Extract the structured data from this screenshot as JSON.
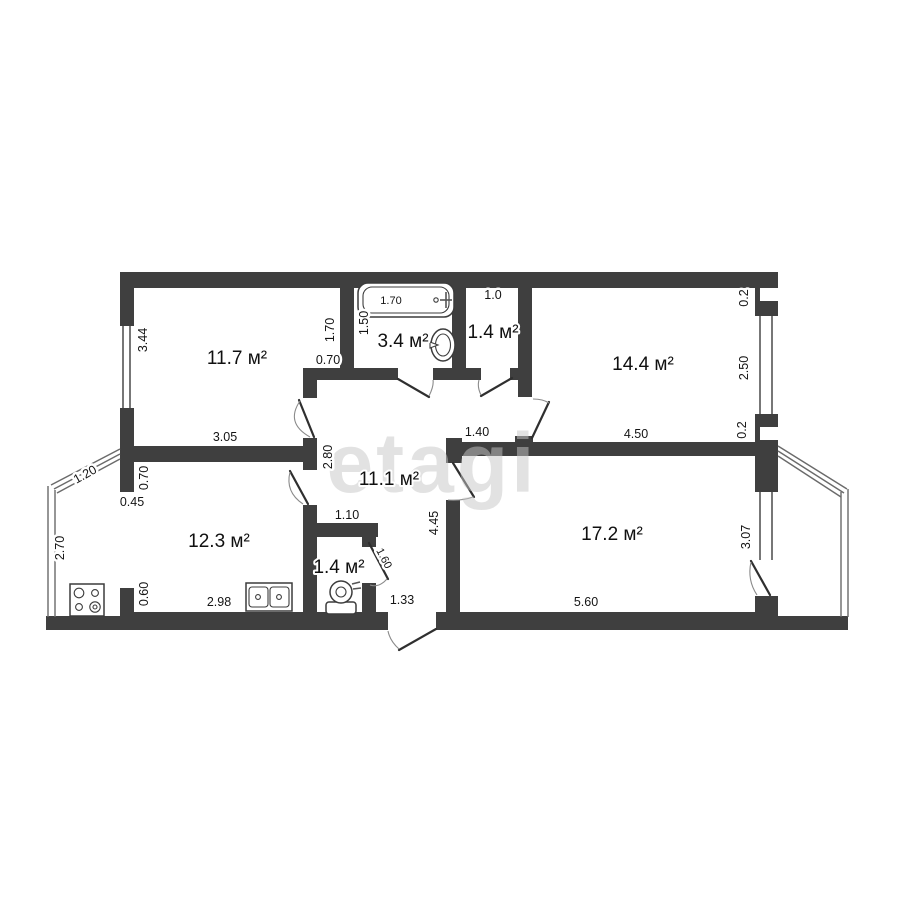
{
  "watermark": "etagi",
  "rooms": {
    "bedroom_top_left": {
      "area": "11.7 м²"
    },
    "bathroom": {
      "area": "3.4 м²"
    },
    "wc_top": {
      "area": "1.4 м²"
    },
    "bedroom_top_right": {
      "area": "14.4 м²"
    },
    "hallway": {
      "area": "11.1 м²"
    },
    "kitchen": {
      "area": "12.3 м²"
    },
    "wc_bottom": {
      "area": "1.4 м²"
    },
    "living_room": {
      "area": "17.2 м²"
    }
  },
  "dimensions": {
    "bedroom_top_left_height": "3.44",
    "bedroom_top_left_width": "3.05",
    "bedroom_top_left_right": "1.70",
    "bedroom_top_left_door": "0.70",
    "bathtub_length": "1.70",
    "bathroom_left": "1.50",
    "wc_top_width": "1.0",
    "bedroom_top_right_offset_top": "0.2",
    "bedroom_top_right_window": "2.50",
    "bedroom_top_right_offset_bottom": "0.2",
    "bedroom_top_right_width": "4.50",
    "hallway_left": "2.80",
    "hallway_opening": "1.40",
    "wc_bottom_width": "1.10",
    "hallway_height": "4.45",
    "wc_bottom_door": "1.60",
    "hallway_bottom": "1.33",
    "kitchen_top_left": "0.70",
    "kitchen_opening": "0.45",
    "kitchen_bottom_left": "0.60",
    "kitchen_width": "2.98",
    "balcony_left_slant": "1.20",
    "balcony_left_height": "2.70",
    "living_room_width": "5.60",
    "living_room_window": "3.07"
  }
}
